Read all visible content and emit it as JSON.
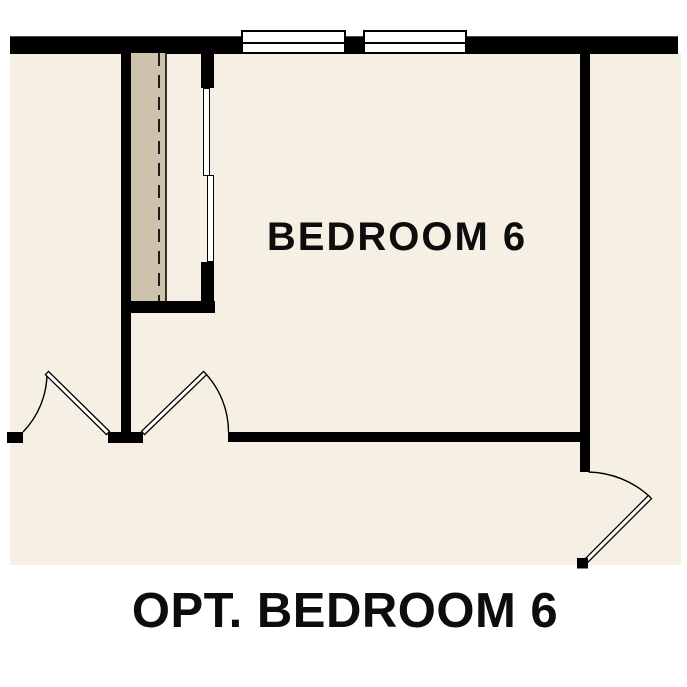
{
  "labels": {
    "room": "BEDROOM 6",
    "caption": "OPT. BEDROOM 6"
  },
  "colors": {
    "background": "#ffffff",
    "floor": "#f6efe4",
    "closet": "#cdc2ab",
    "wall": "#000000",
    "text": "#0d0d0d",
    "window_fill": "#ffffff"
  }
}
